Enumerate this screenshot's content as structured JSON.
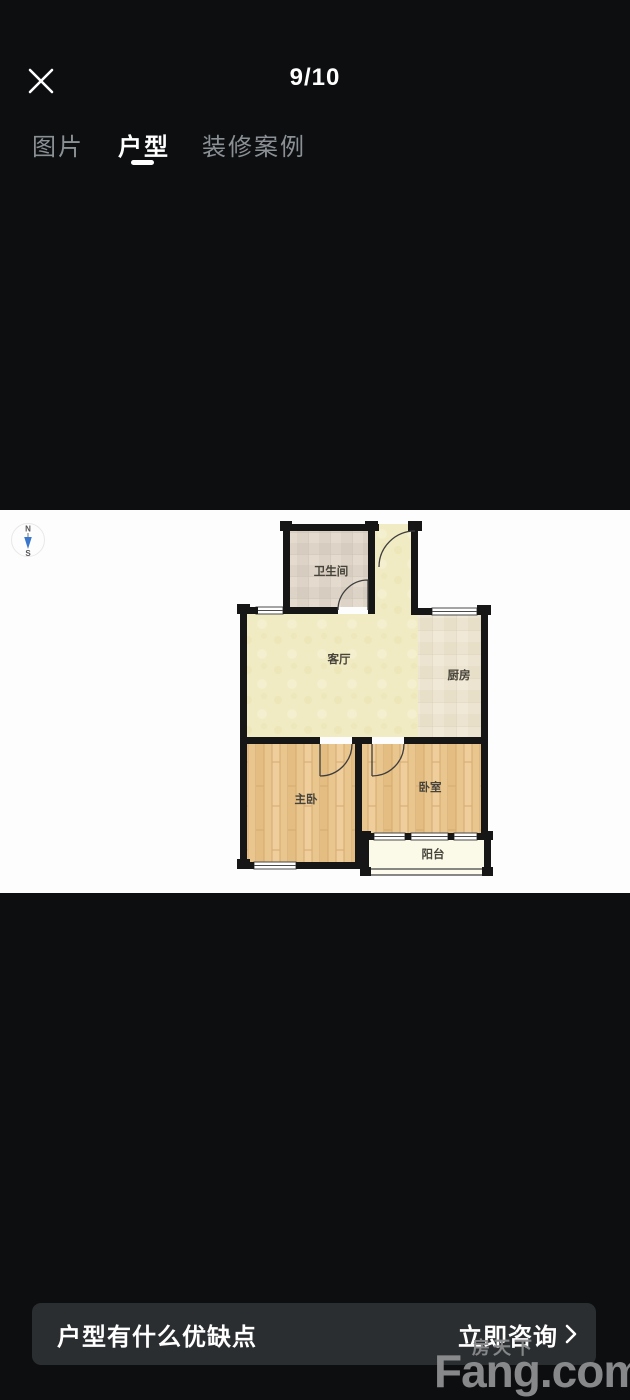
{
  "header": {
    "counter": "9/10"
  },
  "tabs": [
    {
      "label": "图片",
      "active": false
    },
    {
      "label": "户型",
      "active": true
    },
    {
      "label": "装修案例",
      "active": false
    }
  ],
  "floorplan": {
    "compass": {
      "north": "N",
      "south": "S"
    },
    "rooms": [
      {
        "name": "bathroom",
        "label": "卫生间"
      },
      {
        "name": "living-room",
        "label": "客厅"
      },
      {
        "name": "kitchen",
        "label": "厨房"
      },
      {
        "name": "master-bedroom",
        "label": "主卧"
      },
      {
        "name": "bedroom",
        "label": "卧室"
      },
      {
        "name": "balcony",
        "label": "阳台"
      }
    ],
    "colors": {
      "wall": "#161616",
      "living_floor": "#f1ebc3",
      "wood_floor": "#eac68f",
      "bathroom_tile": "#ddd3c6",
      "kitchen_tile": "#ece4d1",
      "balcony_floor": "#fbf9e8",
      "compass_needle": "#3a77cc"
    }
  },
  "bottom_bar": {
    "question": "户型有什么优缺点",
    "cta": "立即咨询"
  },
  "watermark": {
    "small": "房天下",
    "brand": "Fang.com"
  }
}
